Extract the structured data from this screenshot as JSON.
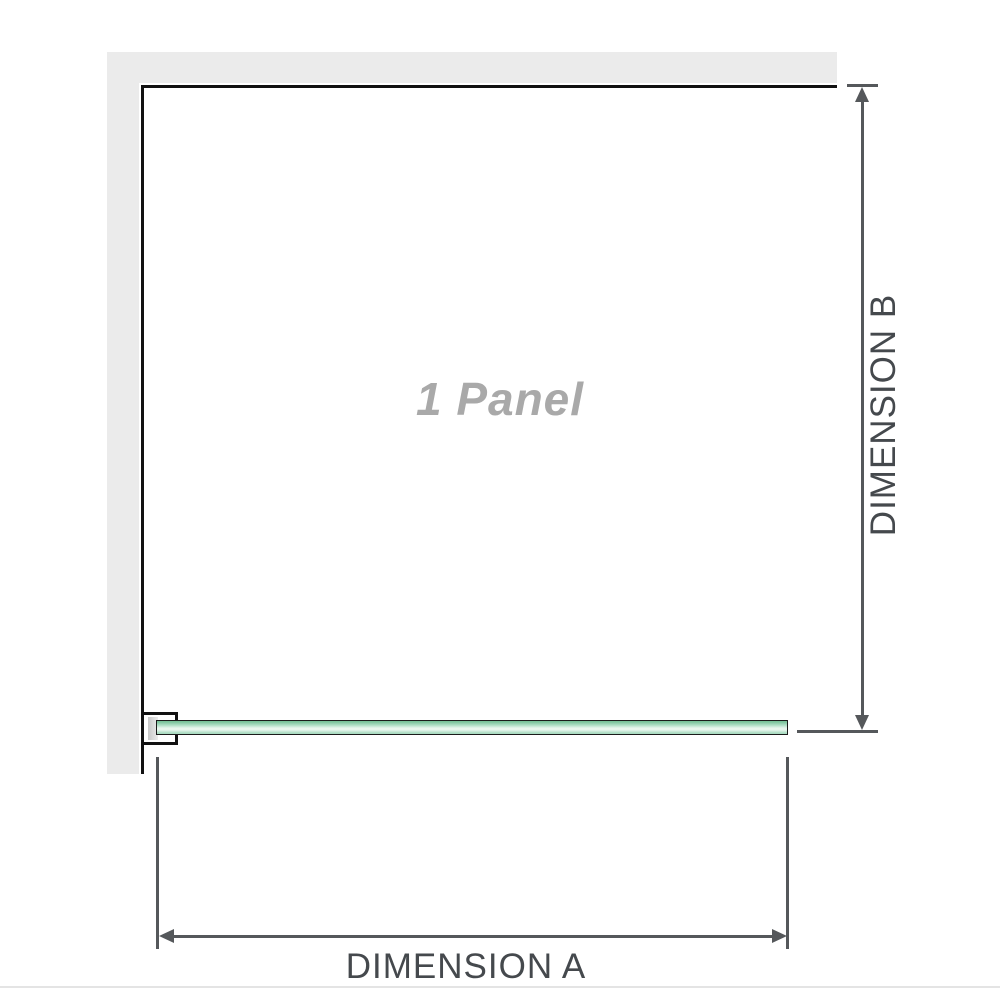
{
  "diagram": {
    "panel_label": "1 Panel",
    "dimension_a": {
      "label": "DIMENSION A",
      "orientation": "horizontal"
    },
    "dimension_b": {
      "label": "DIMENSION B",
      "orientation": "vertical"
    },
    "colors": {
      "wall": "#ebebeb",
      "structure_line": "#111111",
      "dimension_line": "#55585b",
      "dimension_text": "#45494d",
      "panel_text": "#a9a9a9",
      "glass_border": "#1b1b1b",
      "glass_green_dark": "#79c299",
      "glass_green_mid": "#abdcc2",
      "glass_green_light": "#e9f6ee",
      "bracket_fill": "#ffffff",
      "bracket_inner_dark": "#c7c7c7",
      "bracket_inner_light": "#ececec",
      "page_rule": "#e4e4e4",
      "page_bg": "#ffffff"
    }
  }
}
